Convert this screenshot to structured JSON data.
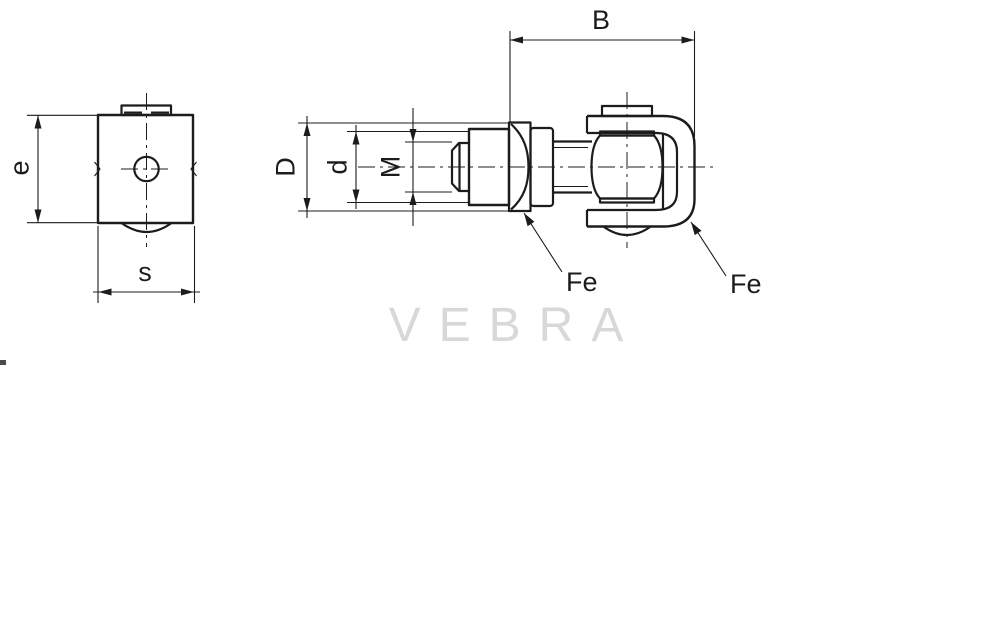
{
  "colors": {
    "ink": "#1c1c1c",
    "watermark": "#d8d8d8",
    "background": "#ffffff"
  },
  "drawing": {
    "front_view": {
      "height_label": "e",
      "width_label": "s"
    },
    "side_view": {
      "outer_dia_label": "D",
      "inner_dia_label": "d",
      "thread_label": "M",
      "width_label": "B",
      "material_label_nut": "Fe",
      "material_label_bracket": "Fe"
    },
    "watermark": "VEBRA"
  }
}
